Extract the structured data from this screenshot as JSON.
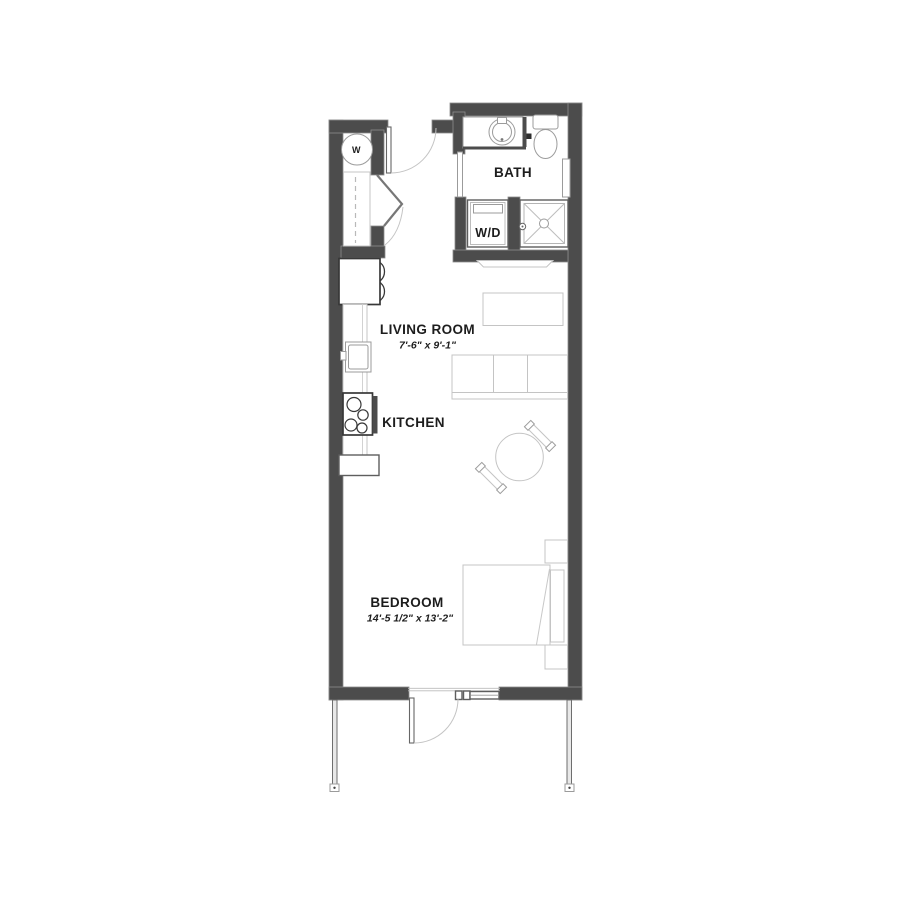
{
  "floor_plan": {
    "rooms": {
      "bath": {
        "label": "BATH"
      },
      "laundry": {
        "label": "W/D"
      },
      "living_room": {
        "label": "LIVING ROOM",
        "dimensions": "7'-6\" x 9'-1\""
      },
      "kitchen": {
        "label": "KITCHEN"
      },
      "bedroom": {
        "label": "BEDROOM",
        "dimensions": "14'-5 1/2\" x 13'-2\""
      },
      "water_heater_closet": {
        "label": "W"
      }
    },
    "colors": {
      "wall": "#4c4c4c",
      "furniture_outline": "#c4c4c4",
      "fixture_outline": "#9b9b9b",
      "appliance_outline": "#383838",
      "label_text": "#1d1d1d",
      "background": "#ffffff"
    }
  }
}
